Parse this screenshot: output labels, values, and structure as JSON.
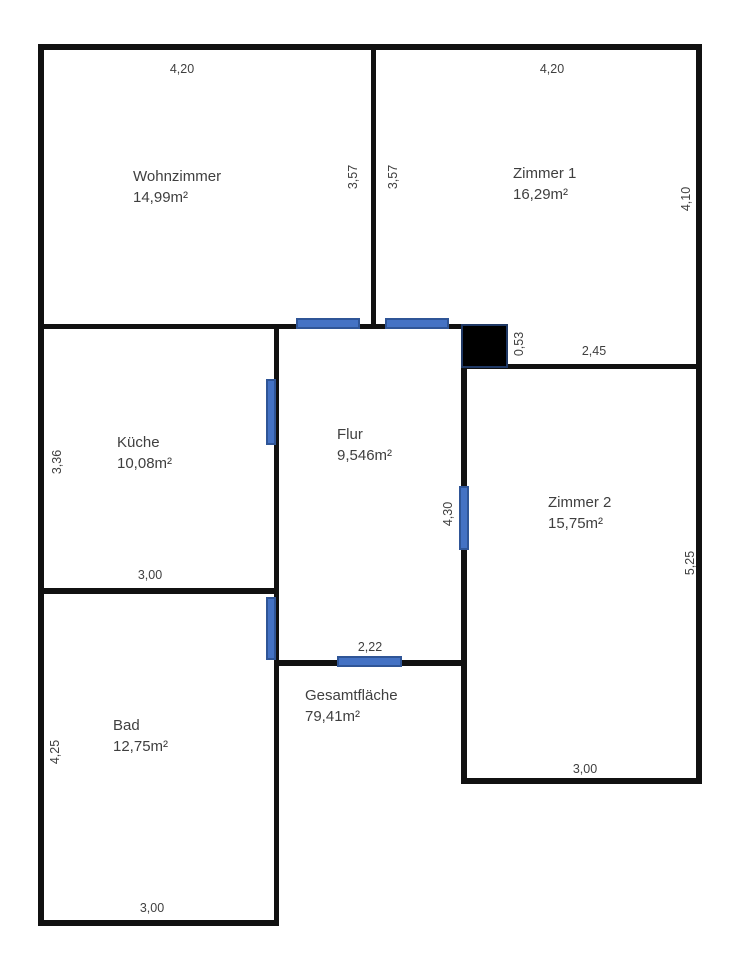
{
  "colors": {
    "background": "#ffffff",
    "wall": "#111111",
    "door_fill": "#4472c4",
    "door_border": "#2f5597",
    "closet_fill": "#000000",
    "closet_border": "#1f3864",
    "text": "#3f3f3f"
  },
  "rooms": {
    "wohnzimmer": {
      "name": "Wohnzimmer",
      "area": "14,99m²"
    },
    "zimmer1": {
      "name": "Zimmer 1",
      "area": "16,29m²"
    },
    "kueche": {
      "name": "Küche",
      "area": "10,08m²"
    },
    "flur": {
      "name": "Flur",
      "area": "9,546m²"
    },
    "zimmer2": {
      "name": "Zimmer 2",
      "area": "15,75m²"
    },
    "bad": {
      "name": "Bad",
      "area": "12,75m²"
    },
    "total": {
      "name": "Gesamtfläche",
      "area": "79,41m²"
    }
  },
  "dimensions": {
    "wohnzimmer_width": "4,20",
    "zimmer1_width": "4,20",
    "wohnzimmer_height": "3,57",
    "zimmer1_height_inner": "3,57",
    "zimmer1_height_outer": "4,10",
    "closet_width": "0,53",
    "zimmer2_top_width": "2,45",
    "kueche_height": "3,36",
    "kueche_width": "3,00",
    "flur_height": "4,30",
    "flur_width": "2,22",
    "bad_height": "4,25",
    "bad_width": "3,00",
    "zimmer2_width": "3,00",
    "zimmer2_height": "5,25"
  }
}
